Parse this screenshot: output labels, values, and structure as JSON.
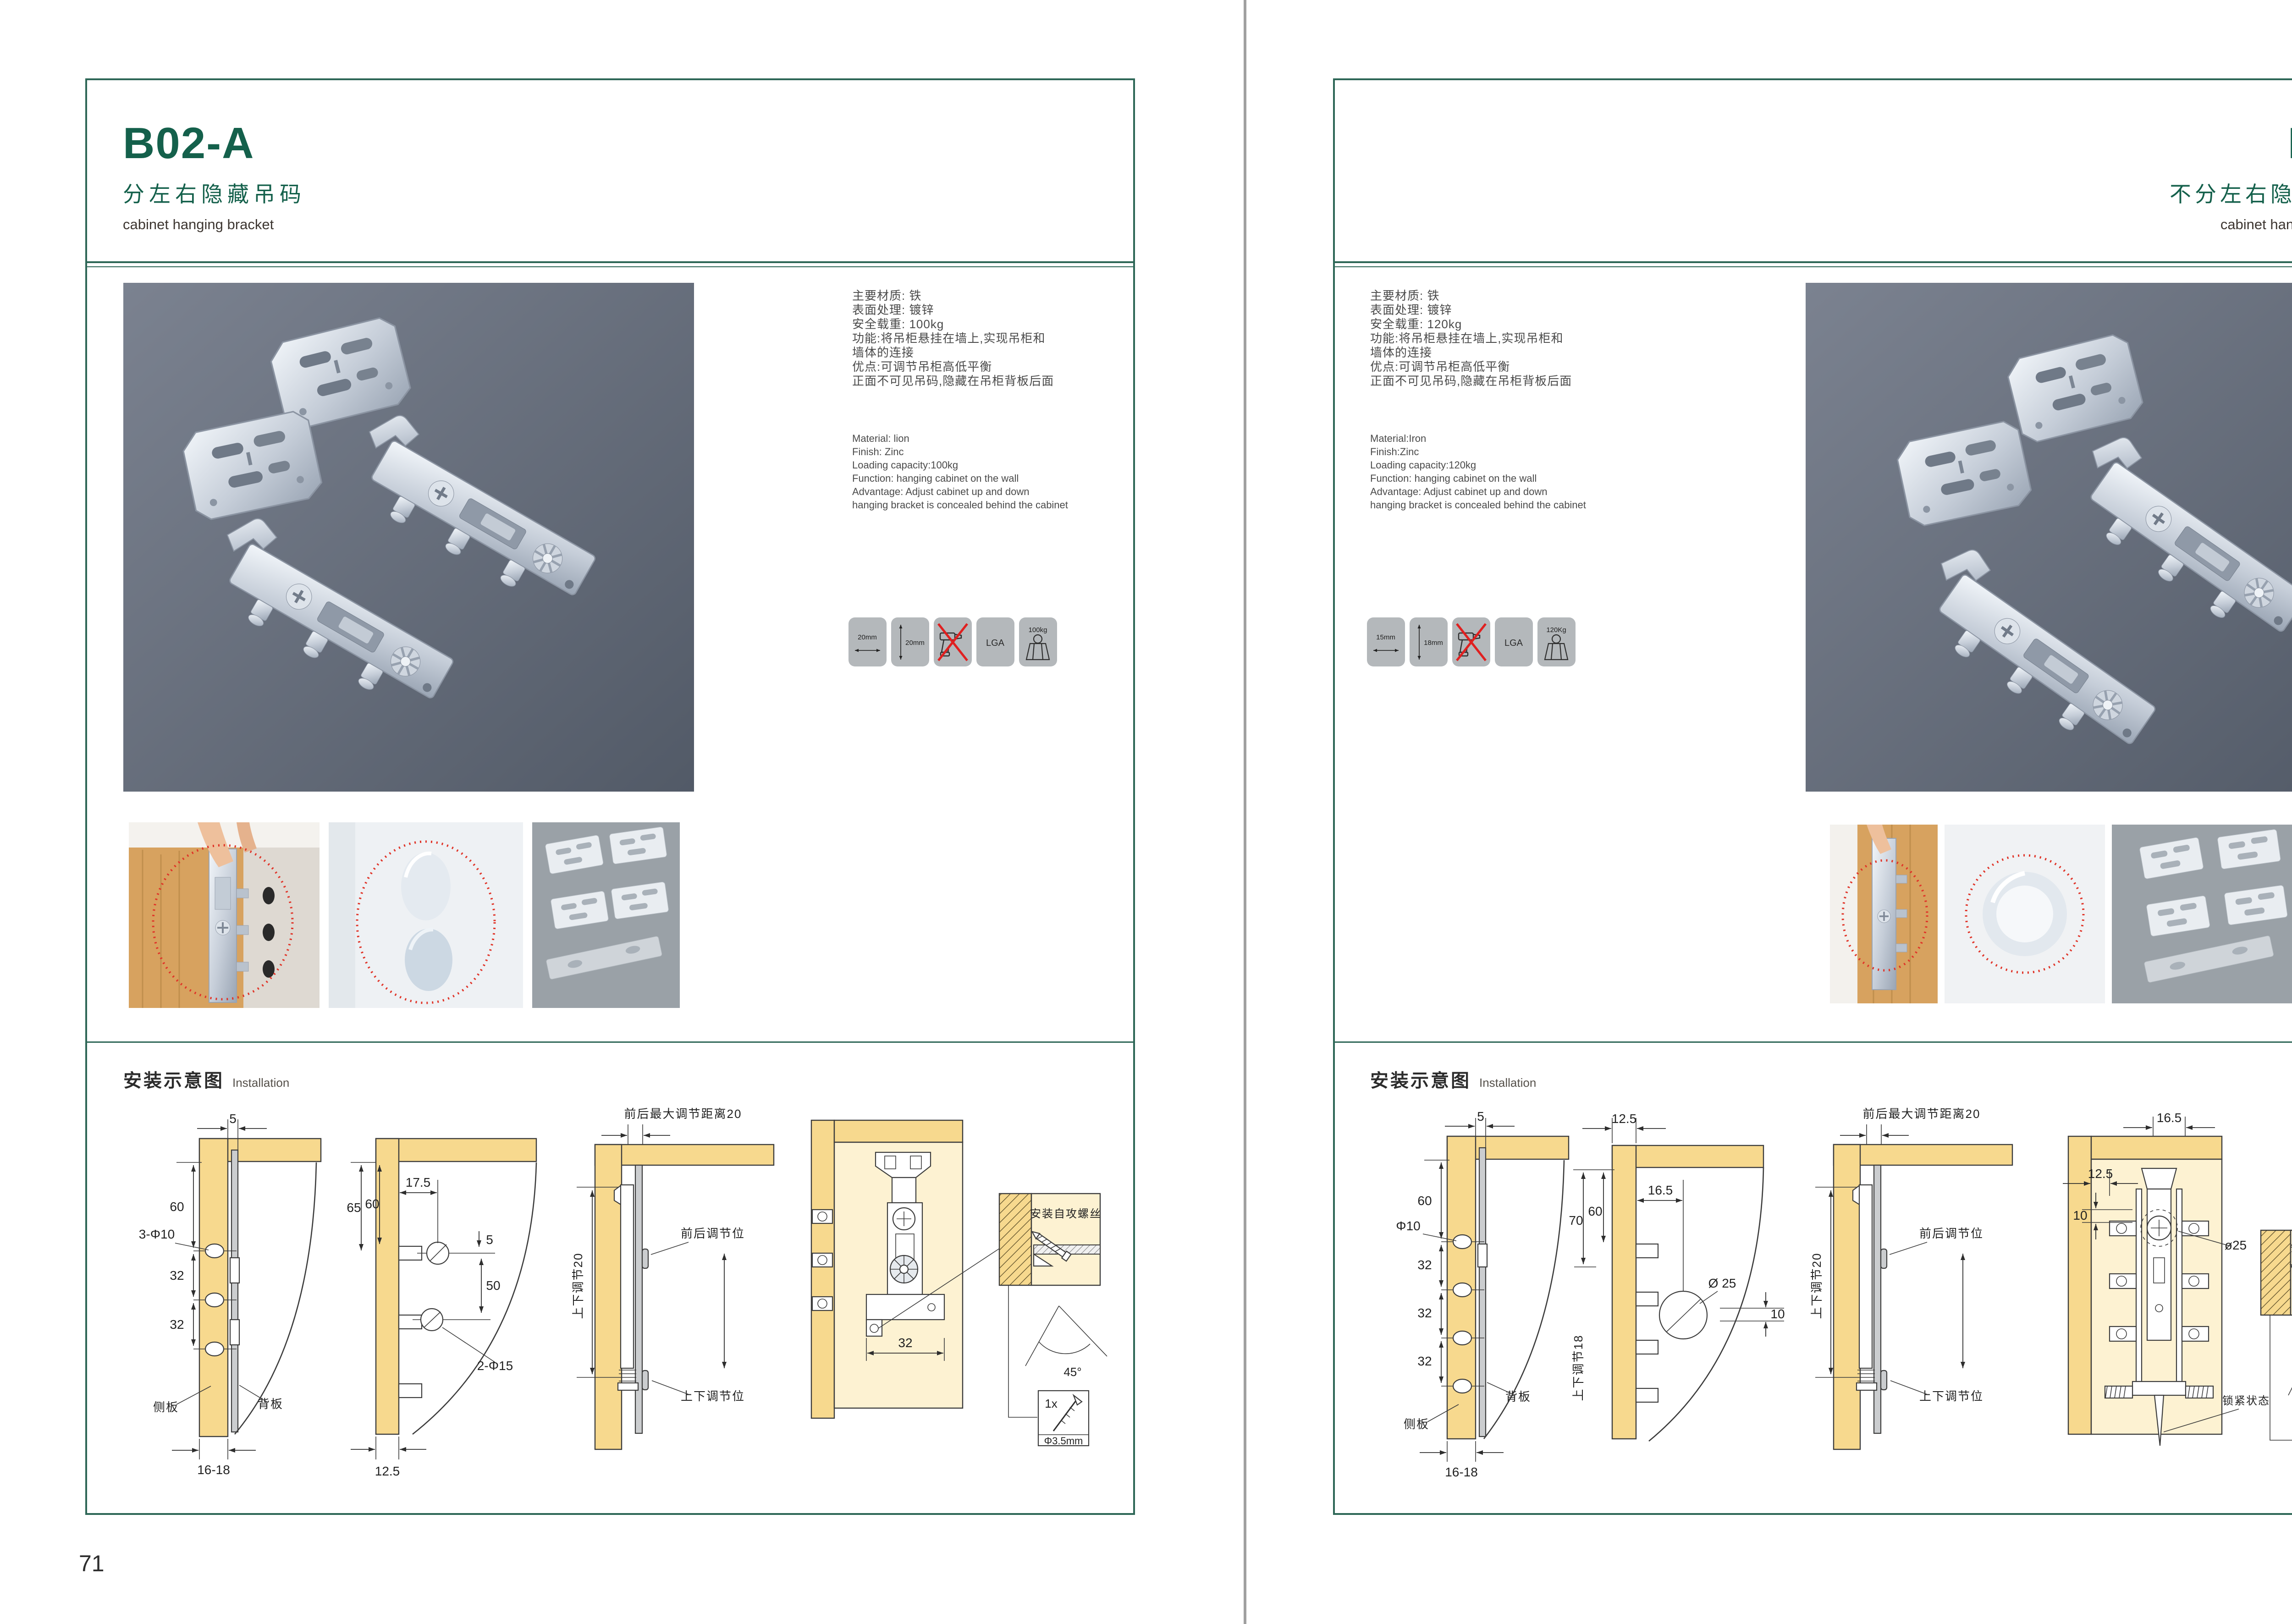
{
  "colors": {
    "brand_green": "#14604b",
    "box_border_green": "#2e6757",
    "badge_gray": "#b4b8bb",
    "wood_yellow": "#f7d98e",
    "accent_red": "#e03428"
  },
  "pages": [
    {
      "code": "B02-A",
      "title_cn": "分左右隐藏吊码",
      "subtitle_en": "cabinet hanging bracket",
      "page_number": "71",
      "specs_cn": [
        "主要材质: 铁",
        "表面处理: 镀锌",
        "安全载重: 100kg",
        "功能:将吊柜悬挂在墙上,实现吊柜和",
        "墙体的连接",
        "优点:可调节吊柜高低平衡",
        "正面不可见吊码,隐藏在吊柜背板后面"
      ],
      "specs_en": [
        "Material: lion",
        "Finish: Zinc",
        "Loading capacity:100kg",
        "Function: hanging cabinet on the wall",
        "Advantage: Adjust cabinet up and down",
        "hanging bracket is concealed behind the cabinet"
      ],
      "badges": {
        "b1": "20mm",
        "b2": "20mm",
        "b4": "LGA",
        "b5": "100kg"
      },
      "install": {
        "cn": "安装示意图",
        "en": "Installation"
      },
      "d1": {
        "top": "5",
        "h60": "60",
        "hole": "3-Φ10",
        "s32a": "32",
        "s32b": "32",
        "side": "侧板",
        "back": "背板",
        "bottom": "16-18"
      },
      "d2": {
        "h65": "65",
        "h60": "60",
        "w175": "17.5",
        "g5": "5",
        "g50": "50",
        "hole": "2-Φ15",
        "bottom": "12.5"
      },
      "d3": {
        "top": "前后最大调节距离20",
        "left": "上下调节20",
        "fb": "前后调节位",
        "ud": "上下调节位"
      },
      "d4": {
        "w32": "32",
        "inset": "安装自攻螺丝",
        "angle": "45°",
        "qty": "1x",
        "dia": "Φ3.5mm"
      }
    },
    {
      "code": "B03",
      "title_cn": "不分左右隐藏吊码",
      "subtitle_en": "cabinet hanging bracket",
      "page_number": "72",
      "specs_cn": [
        "主要材质: 铁",
        "表面处理: 镀锌",
        "安全载重: 120kg",
        "功能:将吊柜悬挂在墙上,实现吊柜和",
        "墙体的连接",
        "优点:可调节吊柜高低平衡",
        "正面不可见吊码,隐藏在吊柜背板后面"
      ],
      "specs_en": [
        "Material:Iron",
        "Finish:Zinc",
        "Loading capacity:120kg",
        "Function: hanging cabinet on the wall",
        "Advantage: Adjust cabinet up and down",
        "hanging bracket is concealed behind the cabinet"
      ],
      "badges": {
        "b1": "15mm",
        "b2": "18mm",
        "b4": "LGA",
        "b5": "120Kg"
      },
      "install": {
        "cn": "安装示意图",
        "en": "Installation"
      },
      "d1": {
        "top": "5",
        "h60": "60",
        "hole": "Φ10",
        "s32a": "32",
        "s32b": "32",
        "s32c": "32",
        "back": "背板",
        "side": "侧板",
        "bottom": "16-18"
      },
      "d2": {
        "top": "12.5",
        "h70": "70",
        "h60": "60",
        "w165": "16.5",
        "hole": "Ø 25",
        "g10": "10",
        "left": "上下调节18"
      },
      "d3": {
        "top": "前后最大调节距离20",
        "left": "上下调节20",
        "fb": "前后调节位",
        "ud": "上下调节位"
      },
      "d4": {
        "top": "16.5",
        "w125": "12.5",
        "g10": "10",
        "hole": "ø25",
        "lock": "锁紧状态",
        "inset": "安装自攻螺丝",
        "angle": "45°",
        "qty": "1x",
        "dia": "Φ3.5mm"
      }
    }
  ]
}
